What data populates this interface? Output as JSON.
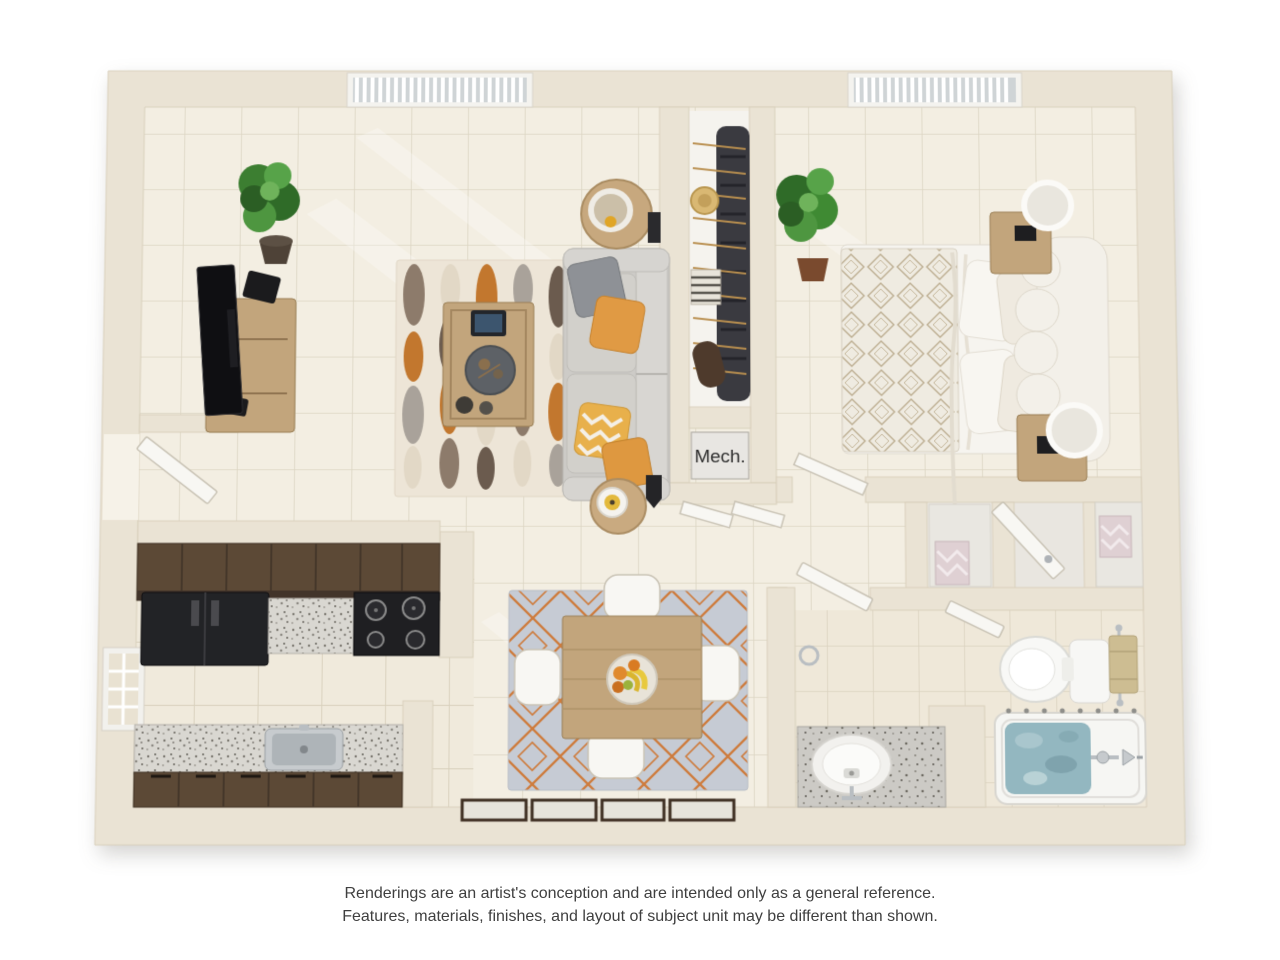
{
  "page": {
    "type": "3D apartment floor plan rendering",
    "background": "#ffffff"
  },
  "labels": {
    "mech_closet": "Mech."
  },
  "disclaimer": {
    "line1": "Renderings are an artist's conception and are intended only as a general reference.",
    "line2": "Features, materials, finishes, and layout of subject unit may be different than shown."
  },
  "rooms": [
    {
      "name": "Living Room",
      "furniture": [
        "tv-console",
        "tv",
        "potted-plant",
        "patterned-area-rug",
        "coffee-table",
        "tablet",
        "sofa",
        "throw-pillows",
        "round-side-tables",
        "lamps",
        "window-with-blinds"
      ]
    },
    {
      "name": "Kitchen",
      "furniture": [
        "upper-cabinets",
        "refrigerator",
        "range-with-burners",
        "speckled-counters",
        "sink",
        "lower-cabinets",
        "window"
      ]
    },
    {
      "name": "Dining Area",
      "furniture": [
        "diamond-pattern-rug",
        "square-wood-table",
        "four-upholstered-chairs",
        "fruit-bowl",
        "patio-door-panels"
      ]
    },
    {
      "name": "Bedroom",
      "furniture": [
        "bed-with-lattice-duvet",
        "scalloped-headboard",
        "two-nightstands",
        "drum-lamps",
        "potted-plant",
        "window-with-blinds"
      ]
    },
    {
      "name": "Walk-in Closet",
      "furniture": [
        "hanging-clothes",
        "hangers",
        "hat",
        "folded-clothes",
        "duffel-bag",
        "bifold-doors"
      ]
    },
    {
      "name": "Mechanical Closet",
      "label": "Mech."
    },
    {
      "name": "Hallway",
      "furniture": [
        "linen-closets",
        "folded-towels",
        "doors"
      ]
    },
    {
      "name": "Bathroom",
      "furniture": [
        "vanity-with-sink",
        "toilet",
        "towel-bar",
        "bathtub-with-water",
        "faucet"
      ]
    }
  ],
  "palette": {
    "pageBg": "#ffffff",
    "wall": "#EAE3D4",
    "wallStroke": "#D9D0BC",
    "wallLight": "#F3EFE4",
    "floor": "#F3EEE2",
    "doorWhite": "#F8F7F3",
    "doorStroke": "#C9C3B5",
    "cabinet": "#5C4936",
    "cabinetDark": "#3D2F21",
    "appliance": "#202124",
    "sofa": "#CDCBC7",
    "pillowGray": "#8E9196",
    "pillowOrange": "#E09A44",
    "woodLight": "#C2A57C",
    "woodMid": "#B0905F",
    "fixture": "#F8F8F5",
    "fixtureStroke": "#D8D6D0",
    "water": "#93B7C0",
    "plantMid": "#3F8A33",
    "towelTan": "#CDBD92",
    "textDark": "#2E2E2E",
    "caption": "#3F3F3F"
  }
}
